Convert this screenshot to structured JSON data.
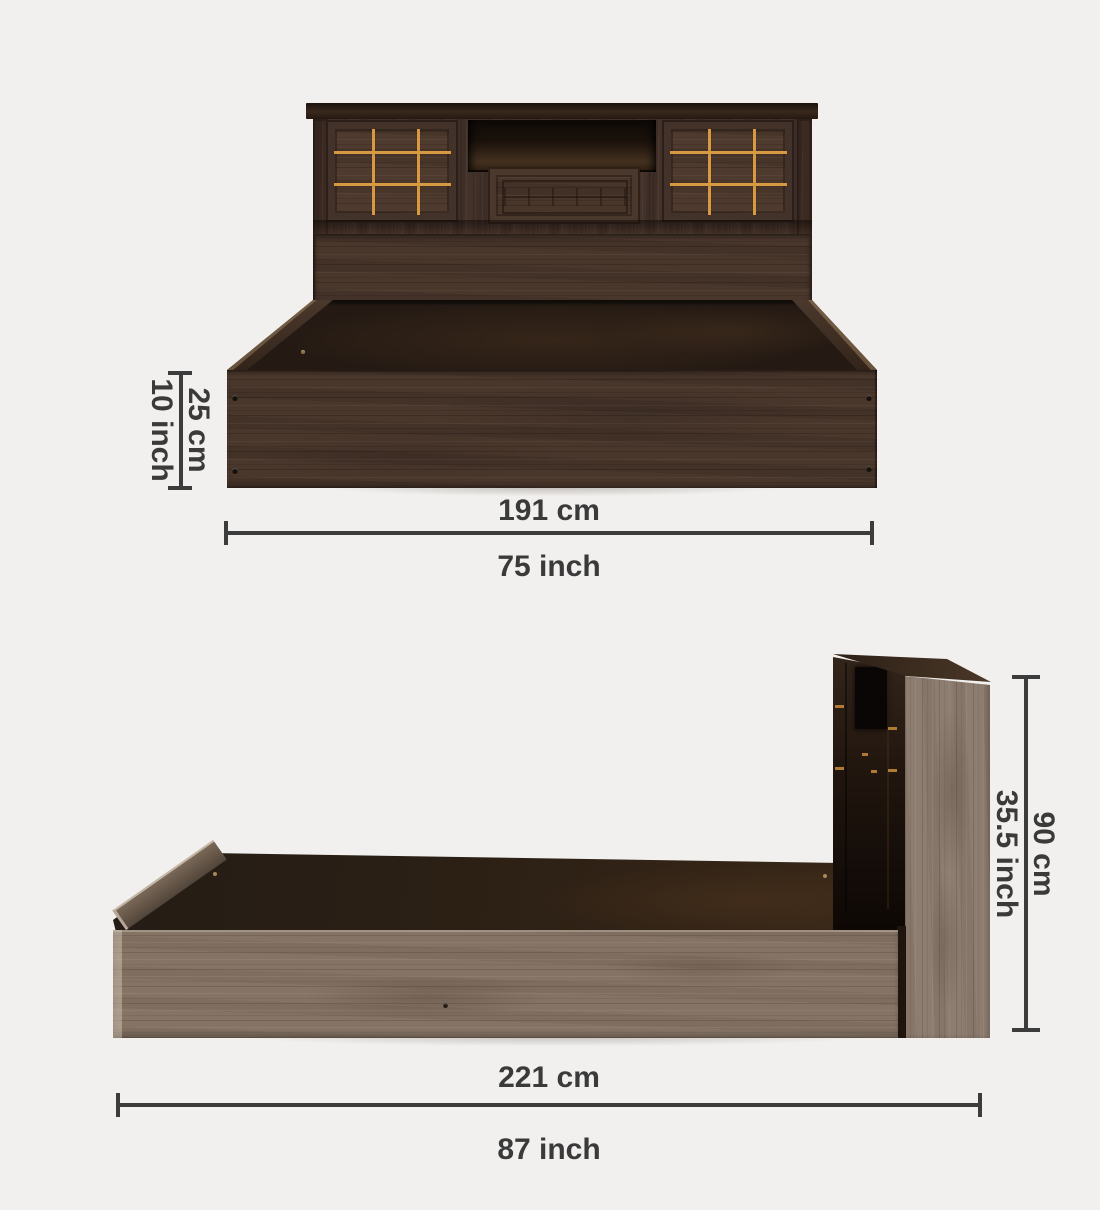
{
  "front_view": {
    "height": {
      "cm": "25 cm",
      "inch": "10 inch"
    },
    "width": {
      "cm": "191 cm",
      "inch": "75 inch"
    }
  },
  "side_view": {
    "height": {
      "cm": "90 cm",
      "inch": "35.5 inch"
    },
    "length": {
      "cm": "221 cm",
      "inch": "87 inch"
    }
  },
  "colors": {
    "background": "#f1f0ee",
    "dimension_line": "#3c3c3c",
    "label_text": "#3a3a3a",
    "walnut_wood": "#46342a",
    "walnut_deck": "#292018",
    "gold_inlay": "#d79a42",
    "greige_wood": "#8b7b6d"
  }
}
